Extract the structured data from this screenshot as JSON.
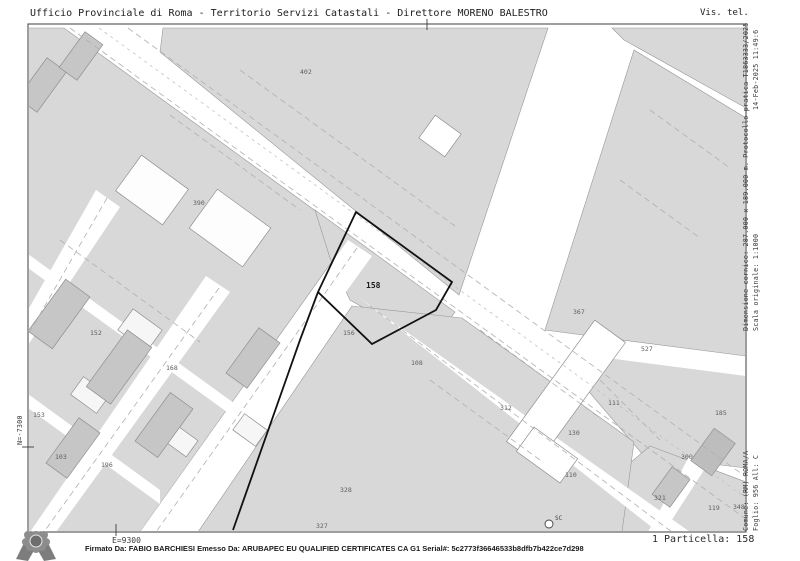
{
  "header": {
    "left": "Ufficio Provinciale di Roma - Territorio Servizi Catastali - Direttore MORENO BALESTRO",
    "right": "Vis. tel."
  },
  "margins": {
    "right_date": "14-Feb-2025 11:49:6",
    "right_protocol": "Dimensione cornice: 287.000 x 189.000 m. Protocollo pratica T1863333/2025",
    "right_scale": "Scala originale: 1:1000",
    "right_comune": "Comune: (RM) ROMA/A",
    "right_foglio": "Foglio: 956 All: C",
    "left_north": "N=-7300",
    "bottom_east": "E=9300"
  },
  "footer": {
    "signature": "Firmato Da: FABIO BARCHIESI Emesso Da: ARUBAPEC EU QUALIFIED CERTIFICATES CA G1 Serial#: 5c2773f36646533b8dfb7b422ce7d298",
    "particella": "1 Particella: 158"
  },
  "map": {
    "subject_parcel": "158",
    "survey_marker": "SC",
    "colors": {
      "block_gray": "#d8d8d8",
      "building_gray": "#c6c6c6",
      "outline_gray": "#989898",
      "dash_gray": "#b0b0b0",
      "subject_outline": "#111111"
    },
    "parcel_labels": [
      {
        "text": "158",
        "x": 366,
        "y": 288,
        "emphasis": true
      },
      {
        "text": "156",
        "x": 343,
        "y": 335
      },
      {
        "text": "390",
        "x": 193,
        "y": 205
      },
      {
        "text": "402",
        "x": 300,
        "y": 74
      },
      {
        "text": "367",
        "x": 573,
        "y": 314
      },
      {
        "text": "527",
        "x": 641,
        "y": 351
      },
      {
        "text": "312",
        "x": 500,
        "y": 410
      },
      {
        "text": "111",
        "x": 608,
        "y": 405
      },
      {
        "text": "130",
        "x": 568,
        "y": 435
      },
      {
        "text": "110",
        "x": 565,
        "y": 477
      },
      {
        "text": "108",
        "x": 411,
        "y": 365
      },
      {
        "text": "185",
        "x": 715,
        "y": 415
      },
      {
        "text": "300",
        "x": 681,
        "y": 459
      },
      {
        "text": "321",
        "x": 654,
        "y": 500
      },
      {
        "text": "119",
        "x": 708,
        "y": 510
      },
      {
        "text": "348",
        "x": 733,
        "y": 509
      },
      {
        "text": "327",
        "x": 316,
        "y": 528
      },
      {
        "text": "328",
        "x": 340,
        "y": 492
      },
      {
        "text": "152",
        "x": 90,
        "y": 335
      },
      {
        "text": "153",
        "x": 33,
        "y": 417
      },
      {
        "text": "103",
        "x": 55,
        "y": 459
      },
      {
        "text": "196",
        "x": 101,
        "y": 467
      },
      {
        "text": "168",
        "x": 166,
        "y": 370
      }
    ]
  }
}
